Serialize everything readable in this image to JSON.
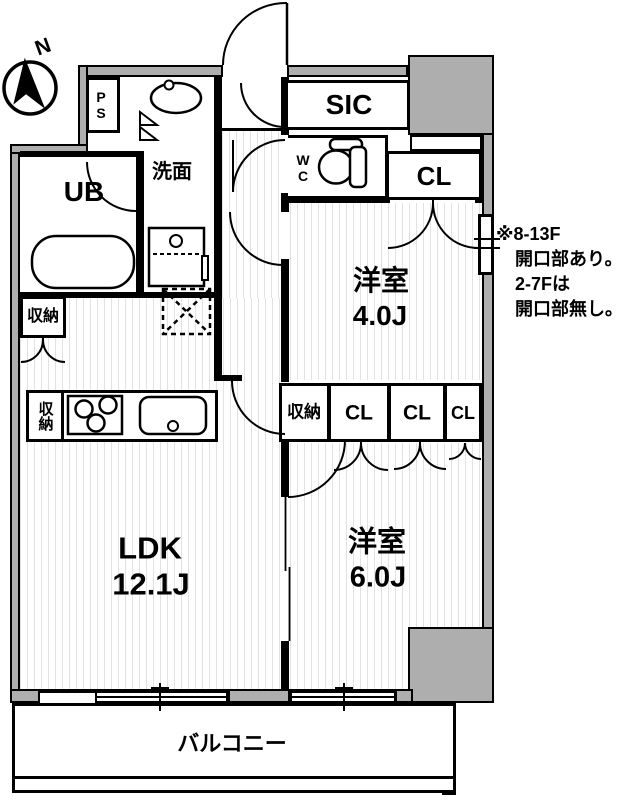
{
  "colors": {
    "wall_fill": "#aeaeae",
    "line": "#000000",
    "floor_hatch": "#e2e2e2"
  },
  "compass": {
    "label": "N"
  },
  "rooms": {
    "ps": {
      "label": "PS"
    },
    "washroom": {
      "label": "洗面"
    },
    "unit_bath": {
      "label": "UB"
    },
    "sic": {
      "label": "SIC"
    },
    "wc": {
      "label": "WC"
    },
    "closet_top": {
      "label": "CL"
    },
    "western_room_4": {
      "name": "洋室",
      "size": "4.0J"
    },
    "storage_mid": {
      "label": "収納"
    },
    "closet_1": {
      "label": "CL"
    },
    "closet_2": {
      "label": "CL"
    },
    "closet_3": {
      "label": "CL"
    },
    "storage_ldk": {
      "label": "収納"
    },
    "storage_kitchen": {
      "label": "収納"
    },
    "ldk": {
      "name": "LDK",
      "size": "12.1J"
    },
    "western_room_6": {
      "name": "洋室",
      "size": "6.0J"
    },
    "balcony": {
      "label": "バルコニー"
    }
  },
  "note": {
    "lines": [
      "※8-13F",
      "開口部あり。",
      "2-7Fは",
      "開口部無し。"
    ]
  }
}
